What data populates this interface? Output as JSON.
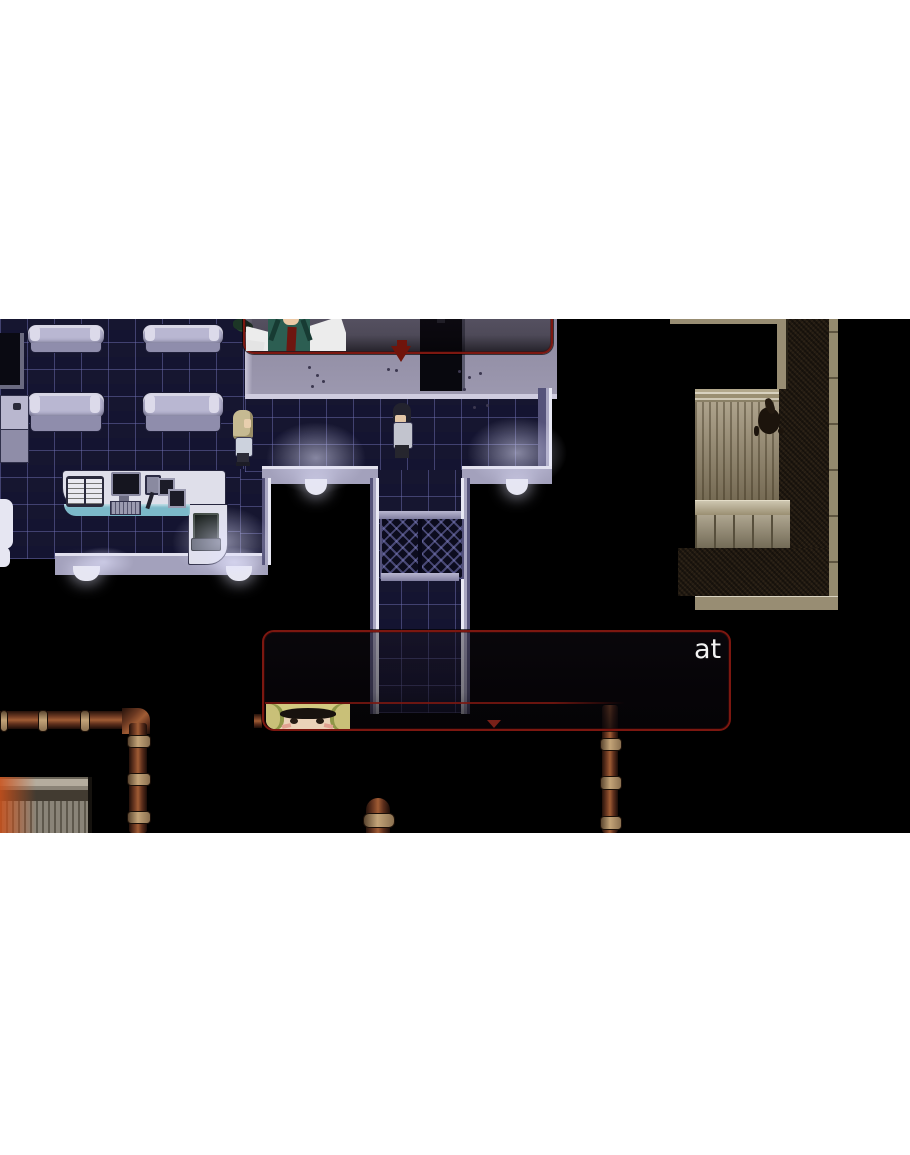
{
  "game": {
    "dialogue_bottom": {
      "visible_text": "at"
    },
    "colors": {
      "page_bg": "#ffffff",
      "game_bg": "#000000",
      "dialog_border": "#7c1710",
      "dialog_line": "#7c1710",
      "tile_base": "#0f0f26",
      "wall_gray": "#9692a9",
      "wall_lavender": "#a3a1bc",
      "trim_white": "#e6e6f2",
      "bed_light": "#b9b7d2",
      "counter_teal": "#7cb9c9",
      "tan_wall": "#988d73",
      "brown_floor": "#241c13",
      "pipe_brown": "#6e3a22",
      "glow": "#e4e4ff",
      "text": "#f2f2f2",
      "arrow_red": "#70140b"
    }
  }
}
